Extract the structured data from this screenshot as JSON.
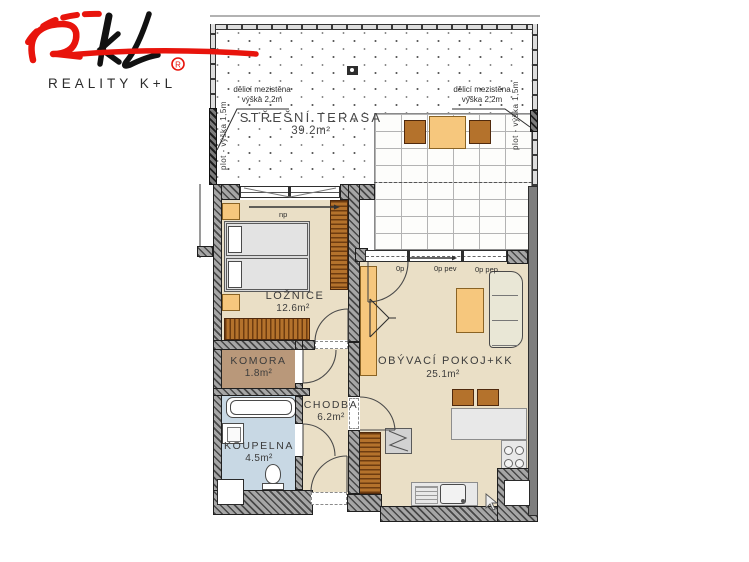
{
  "brand": {
    "name": "REALITY K+L",
    "reg": "®"
  },
  "rooms": {
    "terrace": {
      "name": "STŘEŠNÍ TERASA",
      "area": "39.2m²"
    },
    "bedroom": {
      "name": "LOŽNICE",
      "area": "12.6m²"
    },
    "storage": {
      "name": "KOMORA",
      "area": "1.8m²"
    },
    "hallway": {
      "name": "CHODBA",
      "area": "6.2m²"
    },
    "bathroom": {
      "name": "KOUPELNA",
      "area": "4.5m²"
    },
    "living": {
      "name": "OBÝVACÍ POKOJ+KK",
      "area": "25.1m²"
    }
  },
  "annotations": {
    "fence": "plot - výška 1,5m",
    "partition_line1": "dělicí mezistěna",
    "partition_line2": "výška 2,2m",
    "bedroom_window": "np",
    "opening_left": "0p",
    "opening_mid": "0p pev",
    "opening_right": "0p pep"
  },
  "colors": {
    "accent_red": "#e8140c",
    "floor_beige": "#eadfc6",
    "floor_storage": "#b9987a",
    "floor_bathroom": "#c8d8e4",
    "furniture_orange": "#f6c77d",
    "furniture_brown": "#b4722c",
    "wall_gray": "#7e7e7e"
  }
}
